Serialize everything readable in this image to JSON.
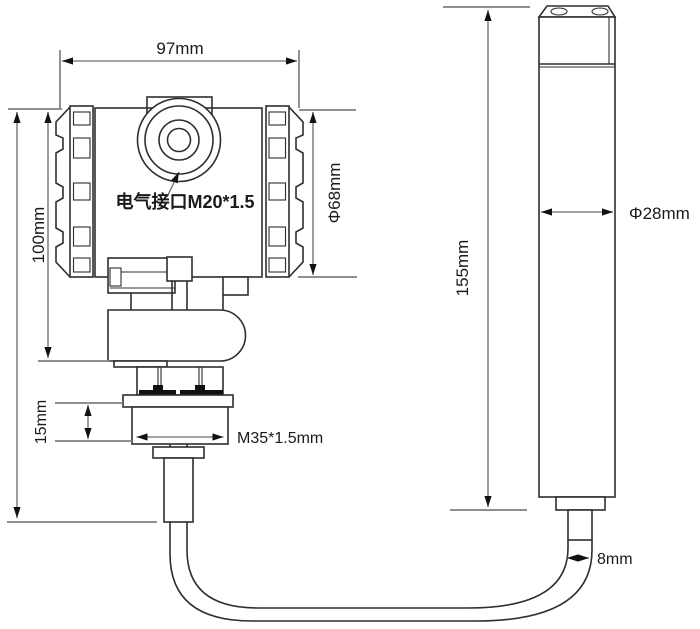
{
  "diagram": {
    "type": "engineering-dimension-drawing",
    "labels": {
      "top_width": "97mm",
      "head_height": "100mm",
      "head_diameter": "Φ68mm",
      "electrical_port": "电气接口M20*1.5",
      "nut_height": "15mm",
      "thread_spec": "M35*1.5mm",
      "probe_length": "155mm",
      "probe_diameter": "Φ28mm",
      "cable_diameter": "8mm"
    },
    "colors": {
      "outline": "#2f2f2f",
      "dimension": "#6a6a6a",
      "extension": "#7f7f7f",
      "text": "#1a1a1a",
      "fill": "#ffffff",
      "arrow": "#111111"
    }
  }
}
